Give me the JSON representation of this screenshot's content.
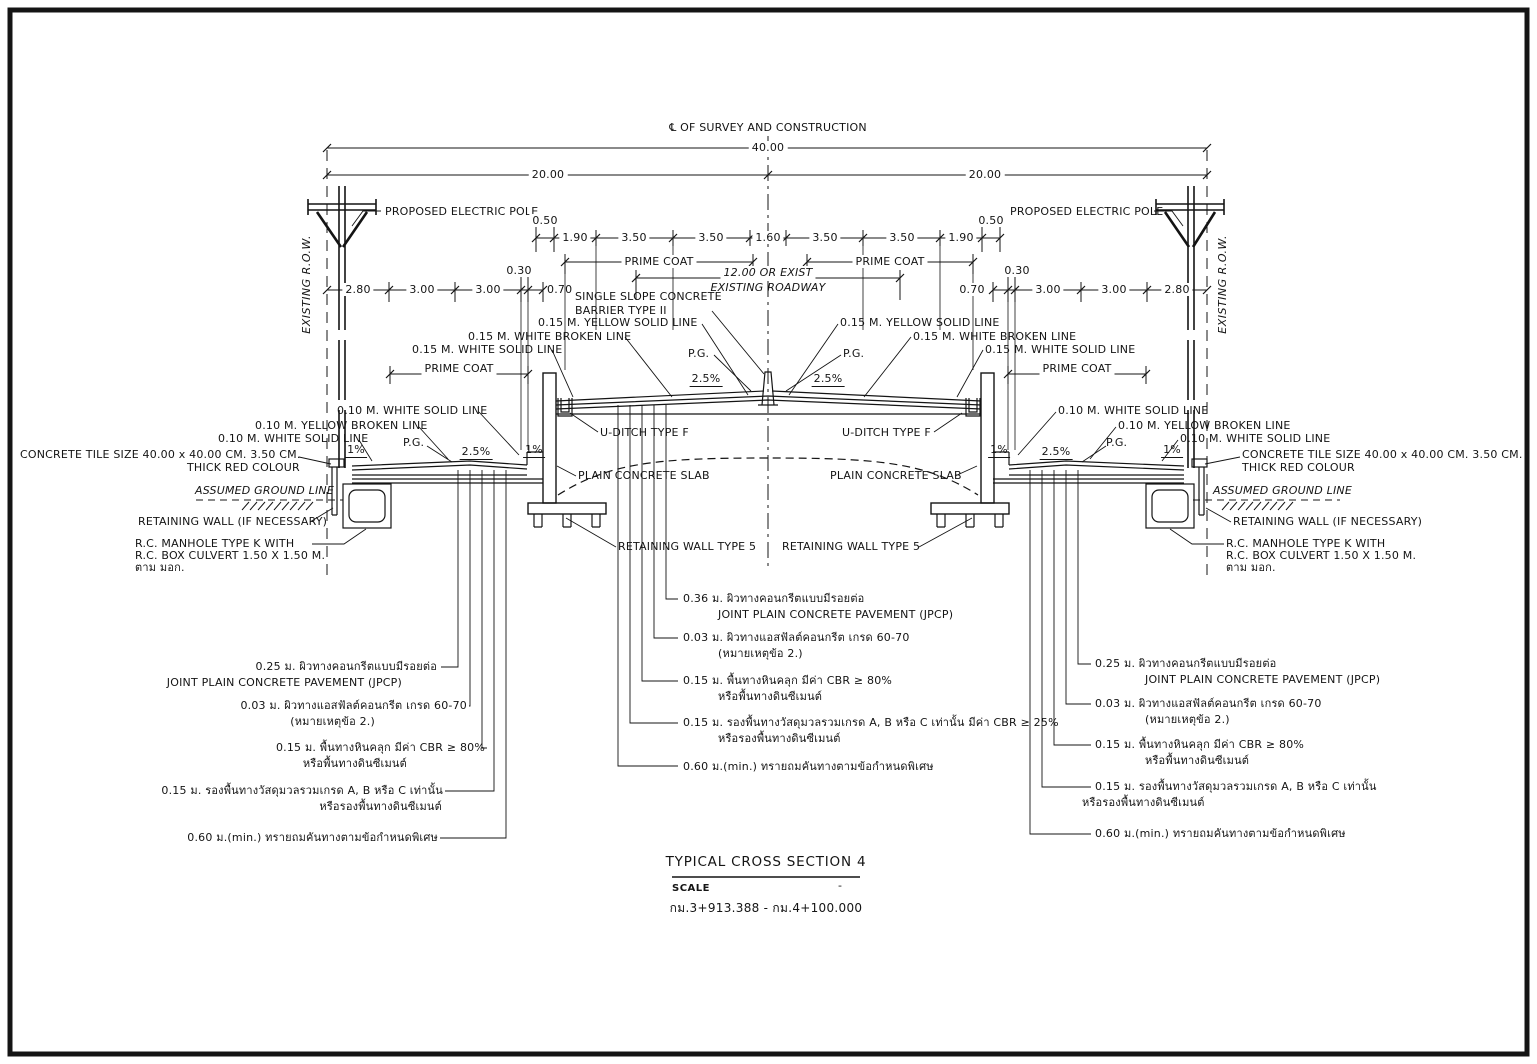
{
  "drawing": {
    "centerline_label": "℄ OF SURVEY AND CONSTRUCTION",
    "dims": {
      "overall": "40.00",
      "half": "20.00",
      "lane_row": [
        "0.50",
        "1.90",
        "3.50",
        "3.50",
        "1.60",
        "3.50",
        "3.50",
        "1.90",
        "0.50"
      ],
      "service_left": [
        "2.80",
        "3.00",
        "3.00",
        "0.30",
        "0.70"
      ],
      "service_right": [
        "0.70",
        "0.30",
        "3.00",
        "3.00",
        "2.80"
      ]
    },
    "labels": {
      "existing_row": "EXISTING R.O.W.",
      "proposed_electric_pole": "PROPOSED ELECTRIC POLE",
      "prime_coat": "PRIME COAT",
      "roadway_width_line1": "12.00 OR EXIST",
      "roadway_width_line2": "EXISTING ROADWAY",
      "barrier_line1": "SINGLE SLOPE CONCRETE",
      "barrier_line2": "BARRIER TYPE II",
      "yellow_solid_015": "0.15 M. YELLOW SOLID LINE",
      "white_broken_015": "0.15 M. WHITE BROKEN LINE",
      "white_solid_015": "0.15 M. WHITE SOLID LINE",
      "white_solid_010": "0.10 M. WHITE SOLID LINE",
      "yellow_broken_010": "0.10 M. YELLOW BROKEN LINE",
      "pg": "P.G.",
      "slope_25": "2.5%",
      "slope_1": "1%",
      "u_ditch": "U-DITCH TYPE F",
      "plain_concrete_slab": "PLAIN CONCRETE SLAB",
      "retaining_wall_type5": "RETAINING WALL TYPE 5",
      "concrete_tile_line1": "CONCRETE TILE SIZE 40.00 x 40.00 CM. 3.50 CM.",
      "concrete_tile_line2": "THICK RED COLOUR",
      "assumed_ground_line": "ASSUMED GROUND LINE",
      "retaining_wall_necessary": "RETAINING WALL (IF NECESSARY)",
      "manhole_line1": "R.C. MANHOLE TYPE K WITH",
      "manhole_line2": "R.C. BOX CULVERT 1.50 X 1.50 M.",
      "manhole_line3": "ตาม มอก."
    },
    "layers_side": {
      "r1a": "0.25 ม. ผิวทางคอนกรีตแบบมีรอยต่อ",
      "r1b": "JOINT PLAIN CONCRETE PAVEMENT (JPCP)",
      "r2a": "0.03 ม. ผิวทางแอสฟัลต์คอนกรีต เกรด 60-70",
      "r2b": "(หมายเหตุข้อ 2.)",
      "r3a": "0.15 ม. พื้นทางหินคลุก มีค่า CBR ≥ 80%",
      "r3b": "หรือพื้นทางดินซีเมนต์",
      "r4a": "0.15 ม. รองพื้นทางวัสดุมวลรวมเกรด A, B หรือ C เท่านั้น",
      "r4b": "หรือรองพื้นทางดินซีเมนต์",
      "r5a": "0.60 ม.(min.) ทรายถมคันทางตามข้อกำหนดพิเศษ"
    },
    "layers_center": {
      "r1a": "0.36 ม. ผิวทางคอนกรีตแบบมีรอยต่อ",
      "r1b": "JOINT PLAIN CONCRETE PAVEMENT (JPCP)",
      "r2a": "0.03 ม. ผิวทางแอสฟัลต์คอนกรีต เกรด 60-70",
      "r2b": "(หมายเหตุข้อ 2.)",
      "r3a": "0.15 ม. พื้นทางหินคลุก มีค่า CBR ≥ 80%",
      "r3b": "หรือพื้นทางดินซีเมนต์",
      "r4a": "0.15 ม. รองพื้นทางวัสดุมวลรวมเกรด A, B หรือ C เท่านั้น มีค่า CBR ≥ 25%",
      "r4b": "หรือรองพื้นทางดินซีเมนต์",
      "r5a": "0.60 ม.(min.) ทรายถมคันทางตามข้อกำหนดพิเศษ"
    },
    "title_block": {
      "title": "TYPICAL CROSS SECTION 4",
      "scale_label": "SCALE",
      "scale_value": "-",
      "station": "กม.3+913.388 - กม.4+100.000"
    }
  }
}
